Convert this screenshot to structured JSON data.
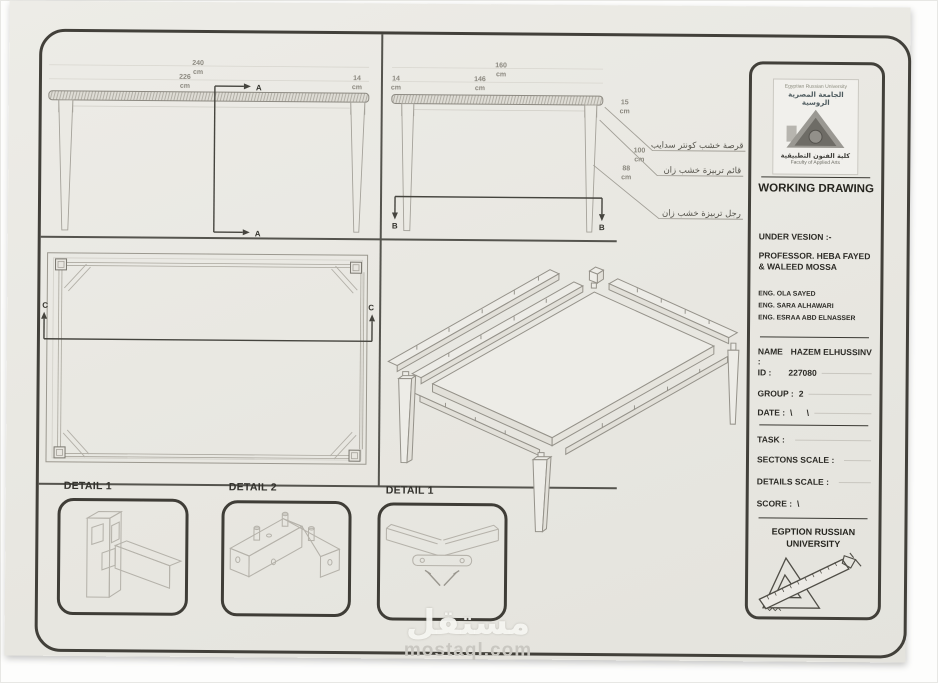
{
  "colors": {
    "ink": "#3c3b36",
    "line_light": "#a39f96",
    "paper": "#e9e8e3"
  },
  "sheet": {
    "views": {
      "unit": "cm",
      "front_elevation": {
        "dim_total": "240",
        "dim_left": "226",
        "dim_overhang": "14",
        "section": "A"
      },
      "side_elevation": {
        "dim_total": "160",
        "dim_left": "14",
        "dim_right": "146",
        "dim_thickness": "15",
        "dim_height": "100",
        "dim_leg": "88",
        "section": "B",
        "callouts": [
          "قرصة خشب كونتر سدايب",
          "قائم تربيزة خشب زان",
          "رجل تربيزة خشب زان"
        ]
      },
      "plan": {
        "section": "C"
      },
      "details": [
        {
          "label": "DETAIL 1"
        },
        {
          "label": "DETAIL 2"
        },
        {
          "label": "DETAIL 1"
        }
      ]
    },
    "title_block": {
      "logo": {
        "university_en": "Egyptian Russian University",
        "university_ar": "الجامعة المصرية الروسية",
        "faculty_ar": "كلية الفنون التطبيقية",
        "faculty_en": "Faculty of Applied Arts"
      },
      "title": "WORKING DRAWING",
      "supervision_heading": "UNDER VESION :-",
      "professor_lines": [
        "PROFESSOR. HEBA FAYED",
        "& WALEED MOSSA"
      ],
      "engineers": [
        "ENG. OLA SAYED",
        "ENG. SARA ALHAWARI",
        "ENG. ESRAA ABD ELNASSER"
      ],
      "info_fields": [
        {
          "label": "NAME :",
          "value": "HAZEM ELHUSSINV"
        },
        {
          "label": "ID :",
          "value": "227080"
        },
        {
          "label": "GROUP :",
          "value": "2"
        },
        {
          "label": "DATE :",
          "value": "\\      \\"
        }
      ],
      "task_fields": [
        {
          "label": "TASK :",
          "value": ""
        },
        {
          "label": "SECTONS SCALE :",
          "value": ""
        },
        {
          "label": "DETAILS SCALE :",
          "value": ""
        },
        {
          "label": "SCORE :",
          "value": "\\"
        }
      ],
      "university_footer_lines": [
        "EGPTION RUSSIAN",
        "UNIVERSITY"
      ]
    }
  },
  "watermark": {
    "name_ar": "مستقل",
    "domain": "mostaql.com"
  }
}
